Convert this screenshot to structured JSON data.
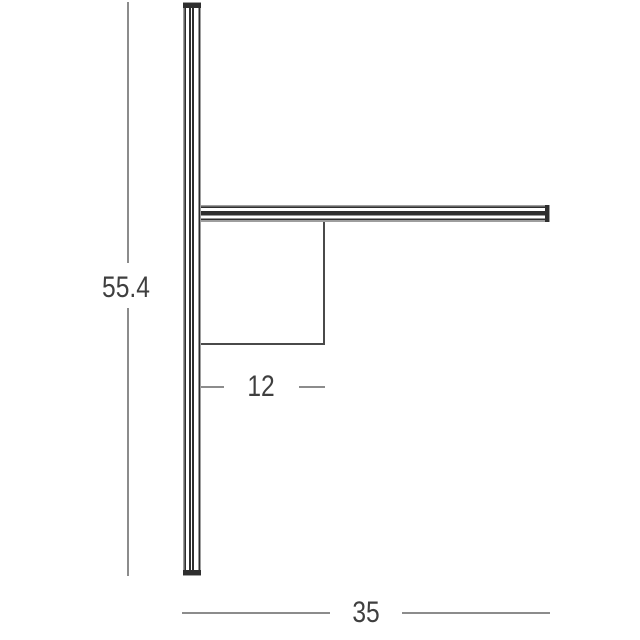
{
  "diagram": {
    "type": "product-dimension-drawing",
    "subject": "wall-light-profile-side-view",
    "dimensions": {
      "height": {
        "label": "55.4",
        "orientation": "vertical"
      },
      "depth": {
        "label": "12",
        "orientation": "horizontal"
      },
      "width": {
        "label": "35",
        "orientation": "horizontal"
      }
    },
    "colors": {
      "background": "#ffffff",
      "dimension_line": "#8c8c8c",
      "profile_dark": "#2e2e2e",
      "profile_edge_gray": "#9e9e9e",
      "box_line": "#4a4a4a",
      "label_text": "#3f3f3f"
    }
  }
}
